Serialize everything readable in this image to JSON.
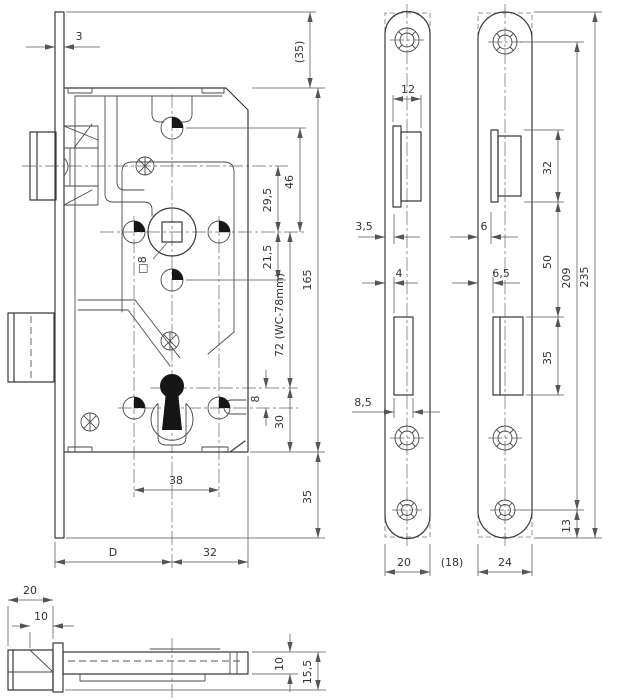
{
  "colors": {
    "background": "#ffffff",
    "outline": "#3a3a3a",
    "dimension": "#555555"
  },
  "front": {
    "labels": {
      "fp_thickness": "3",
      "top_clearance": "(35)",
      "hole_to_hub": "46",
      "screw_to_hub": "29,5",
      "hub_to_hole": "21,5",
      "case_height": "165",
      "hub_to_keyhole": "72 (WC-78mm)",
      "keyhole_offset": "8",
      "keyhole_to_bottom": "30",
      "bottom_section": "35",
      "hole_spacing": "38",
      "backset": "D",
      "hub_to_rear": "32",
      "spindle": "□8"
    }
  },
  "plate20": {
    "labels": {
      "latch_width": "12",
      "latch_offset": "3,5",
      "bolt_offset": "4",
      "bolt_width": "8,5",
      "width": "20",
      "width_alt": "(18)"
    }
  },
  "plate24": {
    "labels": {
      "latch_height": "32",
      "latch_offset": "6",
      "bolt_offset": "6,5",
      "latch_to_bolt": "50",
      "bolt_height": "35",
      "hole_spacing": "209",
      "length": "235",
      "hole_to_end": "13",
      "width": "24"
    }
  },
  "bottom": {
    "labels": {
      "head_width": "20",
      "head_depth": "10",
      "case_depth": "10",
      "total_depth": "15,5"
    }
  }
}
